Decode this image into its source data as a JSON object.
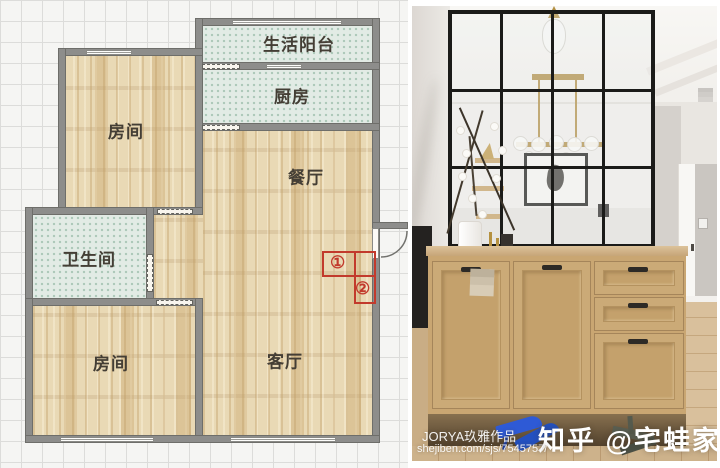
{
  "floor_plan": {
    "rooms": [
      {
        "key": "bedroom_top",
        "label": "房间"
      },
      {
        "key": "balcony",
        "label": "生活阳台"
      },
      {
        "key": "kitchen",
        "label": "厨房"
      },
      {
        "key": "dining",
        "label": "餐厅"
      },
      {
        "key": "bathroom",
        "label": "卫生间"
      },
      {
        "key": "bedroom_bottom",
        "label": "房间"
      },
      {
        "key": "living",
        "label": "客厅"
      }
    ],
    "annotations": [
      {
        "key": "spot1",
        "label": "①"
      },
      {
        "key": "spot2",
        "label": "②"
      }
    ],
    "colors": {
      "wall": "#8d8d8b",
      "wood_floor": "#e9d9b5",
      "tile_floor": "#e2ebe5",
      "annotation_red": "#c23a2c"
    }
  },
  "photo": {
    "watermark_brand": "知乎 @宅蛙家居",
    "credit_line1": "JORYA玖雅作品",
    "credit_line2": "shejiben.com/sjs/7545757/"
  }
}
